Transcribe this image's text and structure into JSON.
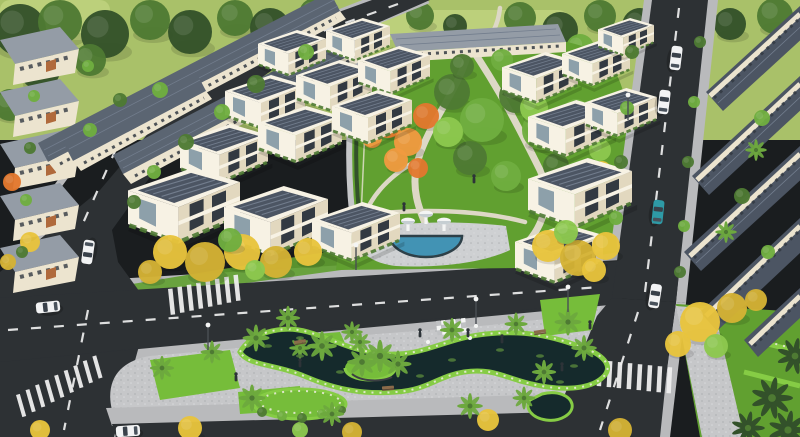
{
  "image": {
    "kind": "3d-aerial-architectural-rendering",
    "subject": "residential villa compound with central park, fountain plaza, ornamental pond park, internal roads, palms and flame trees",
    "width": 800,
    "height": 437
  },
  "palette": {
    "hill": "#a9c169",
    "hillLight": "#bcd07b",
    "treeDark": "#33512a",
    "treeMid": "#4e7a33",
    "treeLight": "#6fae3f",
    "treeBright": "#8cc84e",
    "lawn": "#61a030",
    "lawnBright": "#76bd3a",
    "hedge": "#86cc45",
    "flowerWhite": "#e9ead8",
    "parkPath": "#ddd8c6",
    "road": "#2d3134",
    "marking": "#eeeeee",
    "sidewalk": "#b9babc",
    "curb": "#d0d1d3",
    "paving": "#c6c7c9",
    "pavingLight": "#ced0d2",
    "water": "#152a2c",
    "lily": "#4f7a3a",
    "poolBlue": "#4293b4",
    "poolRim": "#2e4048",
    "white": "#f4f5f4",
    "roofDark": "#4c5563",
    "roofMid": "#5b6572",
    "roofSeam": "#727d8d",
    "roofLight": "#949ca6",
    "wallCream": "#ece4cf",
    "wallBright": "#f7f2e4",
    "wallShade": "#e2d8bf",
    "windowDark": "#333a42",
    "glass": "#8da0aa",
    "terracotta": "#b06a3c",
    "flameOrange": "#e2782e",
    "flameOrange2": "#ef9a40",
    "flameYellow": "#e8c43c",
    "flameYellow2": "#d4b234",
    "palmGreen": "#6da83e",
    "trunk": "#c3bba6",
    "carWhite": "#f2f3f4",
    "carTeal": "#2e9aa6",
    "figure": "#2d3338",
    "bench": "#8a6b4a"
  },
  "scene": {
    "villas": [
      [
        258,
        30,
        0.85
      ],
      [
        326,
        18,
        0.8
      ],
      [
        225,
        75,
        1.0
      ],
      [
        296,
        60,
        0.95
      ],
      [
        358,
        46,
        0.9
      ],
      [
        180,
        124,
        1.1
      ],
      [
        258,
        106,
        1.05
      ],
      [
        332,
        90,
        1.0
      ],
      [
        128,
        168,
        1.4
      ],
      [
        224,
        186,
        1.3
      ],
      [
        312,
        202,
        1.1
      ],
      [
        502,
        52,
        0.95
      ],
      [
        562,
        40,
        0.85
      ],
      [
        598,
        18,
        0.7
      ],
      [
        528,
        100,
        1.05
      ],
      [
        585,
        88,
        0.9
      ],
      [
        528,
        158,
        1.3
      ],
      [
        515,
        224,
        1.1
      ]
    ],
    "canopies": [
      [
        20,
        30,
        26,
        "treeDark",
        "bg"
      ],
      [
        60,
        22,
        22,
        "treeMid",
        "bg"
      ],
      [
        105,
        34,
        24,
        "treeDark",
        "bg"
      ],
      [
        150,
        20,
        20,
        "treeMid",
        "bg"
      ],
      [
        190,
        32,
        22,
        "treeDark",
        "bg"
      ],
      [
        235,
        18,
        18,
        "treeMid",
        "bg"
      ],
      [
        270,
        28,
        20,
        "treeDark",
        "bg"
      ],
      [
        315,
        14,
        16,
        "treeMid",
        "bg"
      ],
      [
        350,
        24,
        14,
        "treeDark",
        "bg"
      ],
      [
        420,
        16,
        14,
        "treeMid",
        "bg"
      ],
      [
        455,
        26,
        12,
        "treeDark",
        "bg"
      ],
      [
        520,
        18,
        16,
        "treeMid",
        "bg"
      ],
      [
        560,
        30,
        18,
        "treeDark",
        "bg"
      ],
      [
        600,
        16,
        16,
        "treeMid",
        "bg"
      ],
      [
        640,
        26,
        18,
        "treeDark",
        "bg"
      ],
      [
        690,
        14,
        14,
        "treeMid",
        "bg"
      ],
      [
        730,
        24,
        16,
        "treeDark",
        "bg"
      ],
      [
        775,
        16,
        18,
        "treeMid",
        "bg"
      ],
      [
        40,
        70,
        20,
        "treeDark",
        "bg"
      ],
      [
        10,
        105,
        16,
        "treeMid",
        "bg"
      ],
      [
        90,
        60,
        16,
        "treeMid",
        "bg"
      ],
      [
        580,
        48,
        14,
        "treeLight",
        "bg"
      ],
      [
        620,
        44,
        12,
        "treeMid",
        "bg"
      ],
      [
        388,
        122,
        16,
        "flameOrange",
        "park"
      ],
      [
        408,
        142,
        14,
        "flameOrange2",
        "park"
      ],
      [
        426,
        116,
        13,
        "flameOrange",
        "park"
      ],
      [
        396,
        160,
        12,
        "flameOrange2",
        "park"
      ],
      [
        418,
        168,
        10,
        "flameOrange",
        "park"
      ],
      [
        372,
        138,
        10,
        "flameOrange2",
        "park"
      ],
      [
        452,
        92,
        18,
        "treeMid",
        "park"
      ],
      [
        482,
        120,
        22,
        "treeLight",
        "park"
      ],
      [
        516,
        96,
        17,
        "treeMid",
        "park"
      ],
      [
        542,
        130,
        20,
        "treeLight",
        "park"
      ],
      [
        470,
        158,
        17,
        "treeMid",
        "park"
      ],
      [
        506,
        176,
        15,
        "treeLight",
        "park"
      ],
      [
        556,
        166,
        13,
        "treeMid",
        "park"
      ],
      [
        576,
        112,
        13,
        "treeLight",
        "park"
      ],
      [
        448,
        132,
        15,
        "treeBright",
        "park"
      ],
      [
        534,
        108,
        14,
        "treeBright",
        "park"
      ],
      [
        600,
        150,
        11,
        "treeBright",
        "park"
      ],
      [
        588,
        186,
        10,
        "treeLight",
        "park"
      ],
      [
        462,
        66,
        12,
        "treeMid",
        "park"
      ],
      [
        502,
        60,
        11,
        "treeLight",
        "park"
      ],
      [
        602,
        170,
        9,
        "flameYellow",
        "park"
      ],
      [
        170,
        252,
        17,
        "flameYellow",
        "street"
      ],
      [
        205,
        262,
        20,
        "flameYellow2",
        "street"
      ],
      [
        242,
        252,
        18,
        "flameYellow",
        "street"
      ],
      [
        276,
        262,
        16,
        "flameYellow2",
        "street"
      ],
      [
        308,
        252,
        14,
        "flameYellow",
        "street"
      ],
      [
        150,
        272,
        12,
        "flameYellow2",
        "street"
      ],
      [
        230,
        240,
        12,
        "treeLight",
        "street"
      ],
      [
        255,
        270,
        10,
        "treeBright",
        "street"
      ],
      [
        548,
        246,
        16,
        "flameYellow",
        "street"
      ],
      [
        578,
        258,
        18,
        "flameYellow2",
        "street"
      ],
      [
        606,
        246,
        14,
        "flameYellow",
        "street"
      ],
      [
        566,
        232,
        12,
        "treeBright",
        "street"
      ],
      [
        594,
        270,
        12,
        "flameYellow",
        "street"
      ],
      [
        700,
        322,
        20,
        "flameYellow",
        "street"
      ],
      [
        732,
        308,
        15,
        "flameYellow2",
        "street"
      ],
      [
        678,
        344,
        13,
        "flameYellow",
        "street"
      ],
      [
        716,
        346,
        12,
        "treeBright",
        "street"
      ],
      [
        756,
        300,
        11,
        "flameYellow2",
        "street"
      ],
      [
        190,
        428,
        12,
        "flameYellow",
        "street"
      ],
      [
        352,
        432,
        10,
        "flameYellow2",
        "street"
      ],
      [
        300,
        430,
        8,
        "treeBright",
        "street"
      ],
      [
        488,
        420,
        11,
        "flameYellow",
        "street"
      ],
      [
        620,
        430,
        12,
        "flameYellow2",
        "street"
      ],
      [
        40,
        430,
        10,
        "flameYellow",
        "street"
      ],
      [
        12,
        182,
        9,
        "flameOrange",
        "street"
      ],
      [
        30,
        242,
        10,
        "flameYellow",
        "street"
      ],
      [
        8,
        262,
        8,
        "flameYellow2",
        "street"
      ],
      [
        256,
        84,
        9,
        "treeMid",
        "street"
      ],
      [
        222,
        112,
        8,
        "treeLight",
        "street"
      ],
      [
        186,
        142,
        8,
        "treeMid",
        "street"
      ],
      [
        154,
        172,
        7,
        "treeLight",
        "street"
      ],
      [
        134,
        202,
        7,
        "treeMid",
        "street"
      ],
      [
        306,
        52,
        8,
        "treeLight",
        "street"
      ],
      [
        632,
        52,
        7,
        "treeMid",
        "street"
      ],
      [
        627,
        108,
        7,
        "treeLight",
        "street"
      ],
      [
        621,
        162,
        7,
        "treeMid",
        "street"
      ],
      [
        616,
        218,
        7,
        "treeLight",
        "street"
      ],
      [
        700,
        42,
        6,
        "treeMid",
        "street"
      ],
      [
        694,
        102,
        6,
        "treeLight",
        "street"
      ],
      [
        688,
        162,
        6,
        "treeMid",
        "street"
      ],
      [
        684,
        226,
        6,
        "treeLight",
        "street"
      ],
      [
        680,
        272,
        6,
        "treeMid",
        "street"
      ],
      [
        762,
        118,
        8,
        "treeLight",
        "street"
      ],
      [
        742,
        196,
        8,
        "treeMid",
        "street"
      ],
      [
        768,
        252,
        7,
        "treeLight",
        "street"
      ],
      [
        34,
        96,
        6,
        "treeLight",
        "street"
      ],
      [
        30,
        148,
        6,
        "treeMid",
        "street"
      ],
      [
        26,
        200,
        6,
        "treeLight",
        "street"
      ],
      [
        22,
        252,
        6,
        "treeMid",
        "street"
      ],
      [
        88,
        66,
        6,
        "treeLight",
        "street"
      ],
      [
        90,
        130,
        7,
        "treeLight",
        "street"
      ],
      [
        120,
        100,
        7,
        "treeMid",
        "street"
      ],
      [
        160,
        90,
        8,
        "treeLight",
        "street"
      ],
      [
        262,
        412,
        5,
        "treeMid",
        "street"
      ],
      [
        282,
        416,
        5,
        "treeLight",
        "street"
      ],
      [
        302,
        418,
        5,
        "treeMid",
        "street"
      ],
      [
        322,
        414,
        5,
        "treeLight",
        "street"
      ],
      [
        342,
        410,
        4,
        "treeMid",
        "street"
      ]
    ],
    "palms": [
      [
        256,
        338,
        1
      ],
      [
        288,
        318,
        0.9
      ],
      [
        322,
        346,
        1.1
      ],
      [
        352,
        332,
        0.8
      ],
      [
        362,
        362,
        1.1
      ],
      [
        380,
        356,
        1.2
      ],
      [
        398,
        364,
        1
      ],
      [
        452,
        330,
        0.9
      ],
      [
        516,
        324,
        0.85
      ],
      [
        568,
        322,
        1
      ],
      [
        584,
        348,
        0.95
      ],
      [
        544,
        372,
        0.9
      ],
      [
        162,
        368,
        0.9
      ],
      [
        212,
        352,
        0.85
      ],
      [
        252,
        398,
        1
      ],
      [
        332,
        414,
        0.9
      ],
      [
        470,
        406,
        0.95
      ],
      [
        524,
        398,
        0.85
      ],
      [
        300,
        348,
        0.8
      ],
      [
        360,
        342,
        0.8
      ],
      [
        756,
        150,
        0.8
      ],
      [
        726,
        232,
        0.8
      ]
    ],
    "dracaenas": [
      [
        772,
        398,
        1.5
      ],
      [
        795,
        356,
        1.3
      ],
      [
        748,
        428,
        1.2
      ],
      [
        788,
        430,
        1.4
      ]
    ],
    "cars": [
      [
        48,
        307,
        -6,
        "carWhite"
      ],
      [
        128,
        431,
        -4,
        "carWhite"
      ],
      [
        88,
        252,
        -82,
        "carWhite"
      ],
      [
        676,
        58,
        97,
        "carWhite"
      ],
      [
        664,
        102,
        97,
        "carWhite"
      ],
      [
        658,
        212,
        96,
        "carTeal"
      ],
      [
        655,
        296,
        99,
        "carWhite"
      ]
    ],
    "lamps": [
      [
        356,
        270
      ],
      [
        568,
        312
      ],
      [
        208,
        350
      ],
      [
        628,
        120
      ],
      [
        476,
        324
      ]
    ],
    "people": [
      [
        420,
        336
      ],
      [
        468,
        336
      ],
      [
        502,
        342
      ],
      [
        562,
        370
      ],
      [
        236,
        380
      ],
      [
        590,
        328
      ],
      [
        404,
        210
      ],
      [
        474,
        182
      ],
      [
        300,
        366
      ]
    ],
    "benches": [
      [
        388,
        388,
        -4
      ],
      [
        540,
        332,
        -8
      ],
      [
        300,
        342,
        -10
      ]
    ],
    "lilies": [
      [
        268,
        346
      ],
      [
        300,
        356
      ],
      [
        340,
        372
      ],
      [
        420,
        376
      ],
      [
        452,
        360
      ],
      [
        500,
        350
      ],
      [
        540,
        356
      ],
      [
        574,
        366
      ],
      [
        300,
        338
      ],
      [
        560,
        382
      ]
    ],
    "crosswalks": [
      {
        "x": 168,
        "y": 289,
        "n": 8,
        "dx": 9.5,
        "dy": -1,
        "w": 4.5,
        "h": 26,
        "rot": -6
      },
      {
        "x": 16,
        "y": 395,
        "n": 9,
        "dx": 10.5,
        "dy": -2,
        "w": 4,
        "h": 23,
        "rot": -16
      },
      {
        "x": 598,
        "y": 360,
        "n": 8,
        "dx": 10,
        "dy": 0.5,
        "w": 4.5,
        "h": 26,
        "rot": 3
      }
    ],
    "fountain_jets": [
      [
        408,
        231
      ],
      [
        426,
        224
      ],
      [
        444,
        231
      ]
    ],
    "pergola": {
      "x": 436,
      "y": 321,
      "cols": 6,
      "rows": 3,
      "cell": 5,
      "rot": -6
    },
    "chairs": [
      [
        428,
        342
      ],
      [
        470,
        338
      ],
      [
        476,
        326
      ],
      [
        420,
        332
      ]
    ],
    "apartment_rows": [
      [
        0,
        40
      ],
      [
        0,
        92
      ],
      [
        0,
        144
      ],
      [
        0,
        196
      ],
      [
        0,
        248
      ]
    ]
  }
}
